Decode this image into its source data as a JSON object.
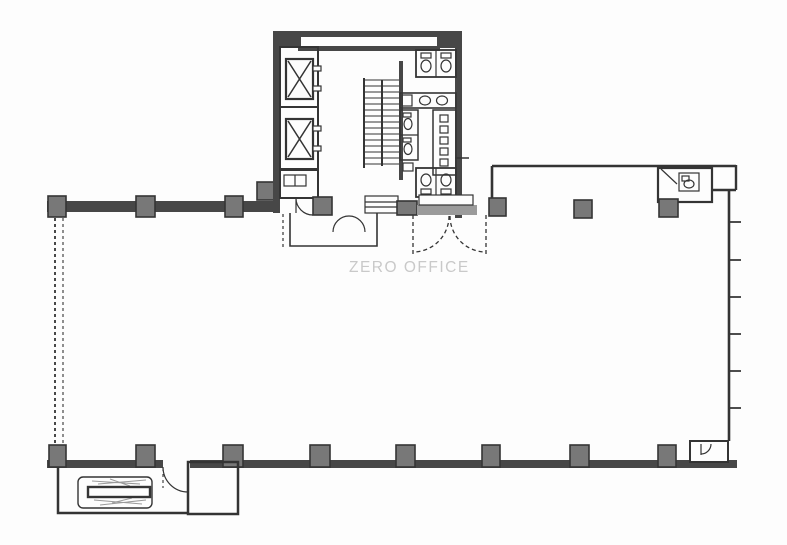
{
  "watermark": {
    "text": "ZERO OFFICE"
  },
  "colors": {
    "background": "#fdfdfd",
    "line": "#343434",
    "wall_dark": "#474747",
    "wall_medium": "#9b9b9b",
    "column_fill": "#787878",
    "hatch": "#9a9a9a",
    "watermark": "#c9c9c9"
  },
  "icons": {
    "elevator": "rect-with-x",
    "stairs": "ladder-treads",
    "toilet": "oval-bowl-with-tank",
    "sink": "oval-basin-counter",
    "door": "quarter-arc-swing",
    "double-door": "paired-quarter-arcs",
    "escalator": "looped-belt-with-hatch",
    "window": "dashed-double-line",
    "mullion": "tick-marks",
    "column": "filled-square"
  }
}
